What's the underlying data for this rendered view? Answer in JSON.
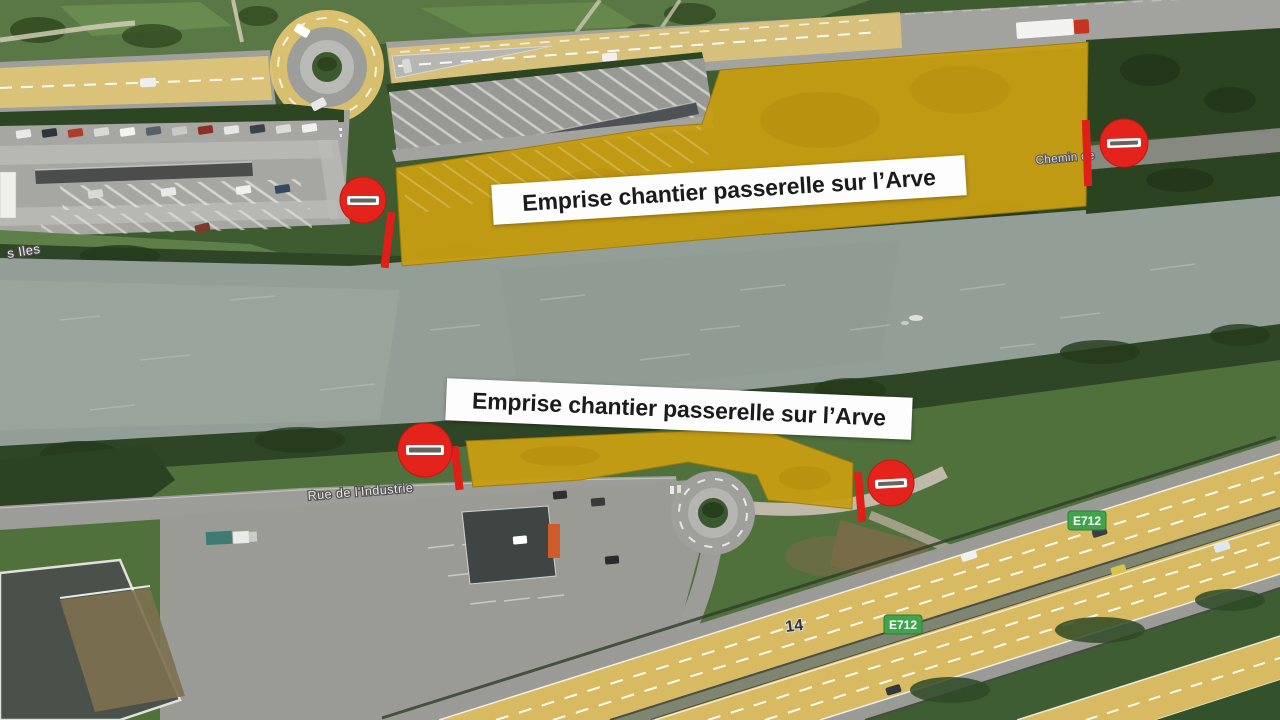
{
  "banners": {
    "top": "Emprise chantier passerelle sur l’Arve",
    "bottom": "Emprise chantier passerelle sur l’Arve"
  },
  "road_labels": {
    "chemin_de": "Chemin de",
    "rue_industrie": "Rue de l'Industrie",
    "iles": "s Iles"
  },
  "highway_labels": {
    "badge_upper": "E712",
    "badge_lower": "E712",
    "exit_number": "14"
  },
  "icons": {
    "no_entry": "no-entry-icon"
  },
  "colors": {
    "construction_zone_yellow": "#c79d13",
    "no_entry_red": "#e3231c",
    "closure_bar_red": "#e02018",
    "route_badge_green": "#3fa44b",
    "river_gray_green": "#939f96",
    "road_overlay_yellow": "#e5c873",
    "banner_background": "#fdfdfd",
    "banner_text": "#1b1b1b"
  }
}
